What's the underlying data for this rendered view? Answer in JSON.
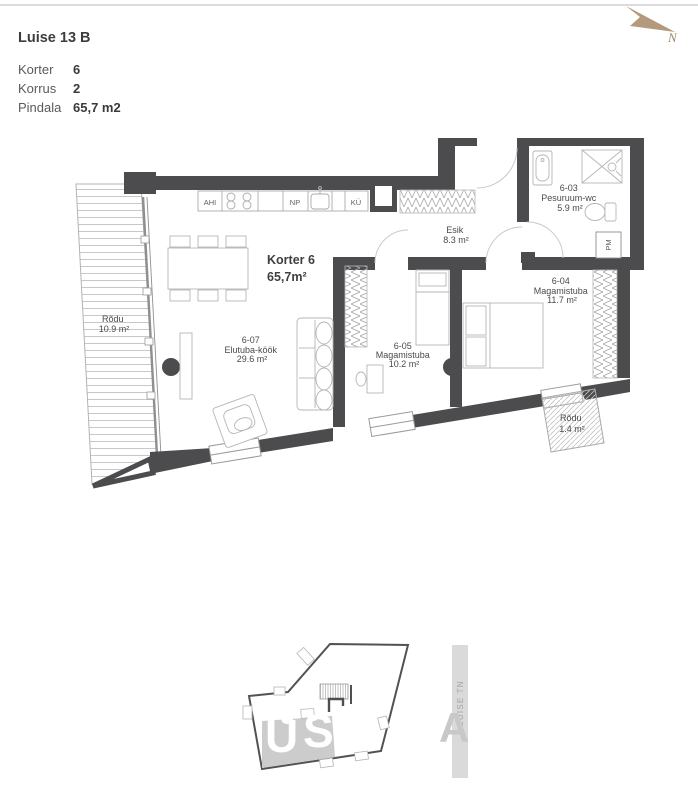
{
  "header": {
    "title": "Luise 13 B",
    "rows": [
      {
        "label": "Korter",
        "value": "6"
      },
      {
        "label": "Korrus",
        "value": "2"
      },
      {
        "label": "Pindala",
        "value": "65,7 m2"
      }
    ]
  },
  "compass": {
    "label": "N"
  },
  "plan": {
    "apartment": {
      "name": "Korter 6",
      "area": "65,7m²"
    },
    "rooms": [
      {
        "id": "6-07",
        "name": "Elutuba-köök",
        "area": "29.6 m²"
      },
      {
        "id": "6-05",
        "name": "Magamistuba",
        "area": "10.2 m²"
      },
      {
        "id": "6-04",
        "name": "Magamistuba",
        "area": "11.7 m²"
      },
      {
        "id": "6-03",
        "name": "Pesuruum-wc",
        "area": "5.9 m²"
      },
      {
        "id": "",
        "name": "Esik",
        "area": "8.3 m²"
      },
      {
        "id": "",
        "name": "Rõdu",
        "area": "10.9 m²"
      },
      {
        "id": "",
        "name": "Rõdu",
        "area": "1.4 m²"
      }
    ],
    "kitchen": {
      "ahi": "AHI",
      "np": "NP",
      "ku": "KÜ"
    },
    "appliances": {
      "pm": "PM"
    }
  },
  "siteplan": {
    "street": "LUISE TN",
    "watermark": [
      "U",
      "S",
      "A"
    ]
  },
  "colors": {
    "wall": "#4c4c4f",
    "north_arrow": "#b49a7c",
    "highlight": "#cccccc"
  }
}
